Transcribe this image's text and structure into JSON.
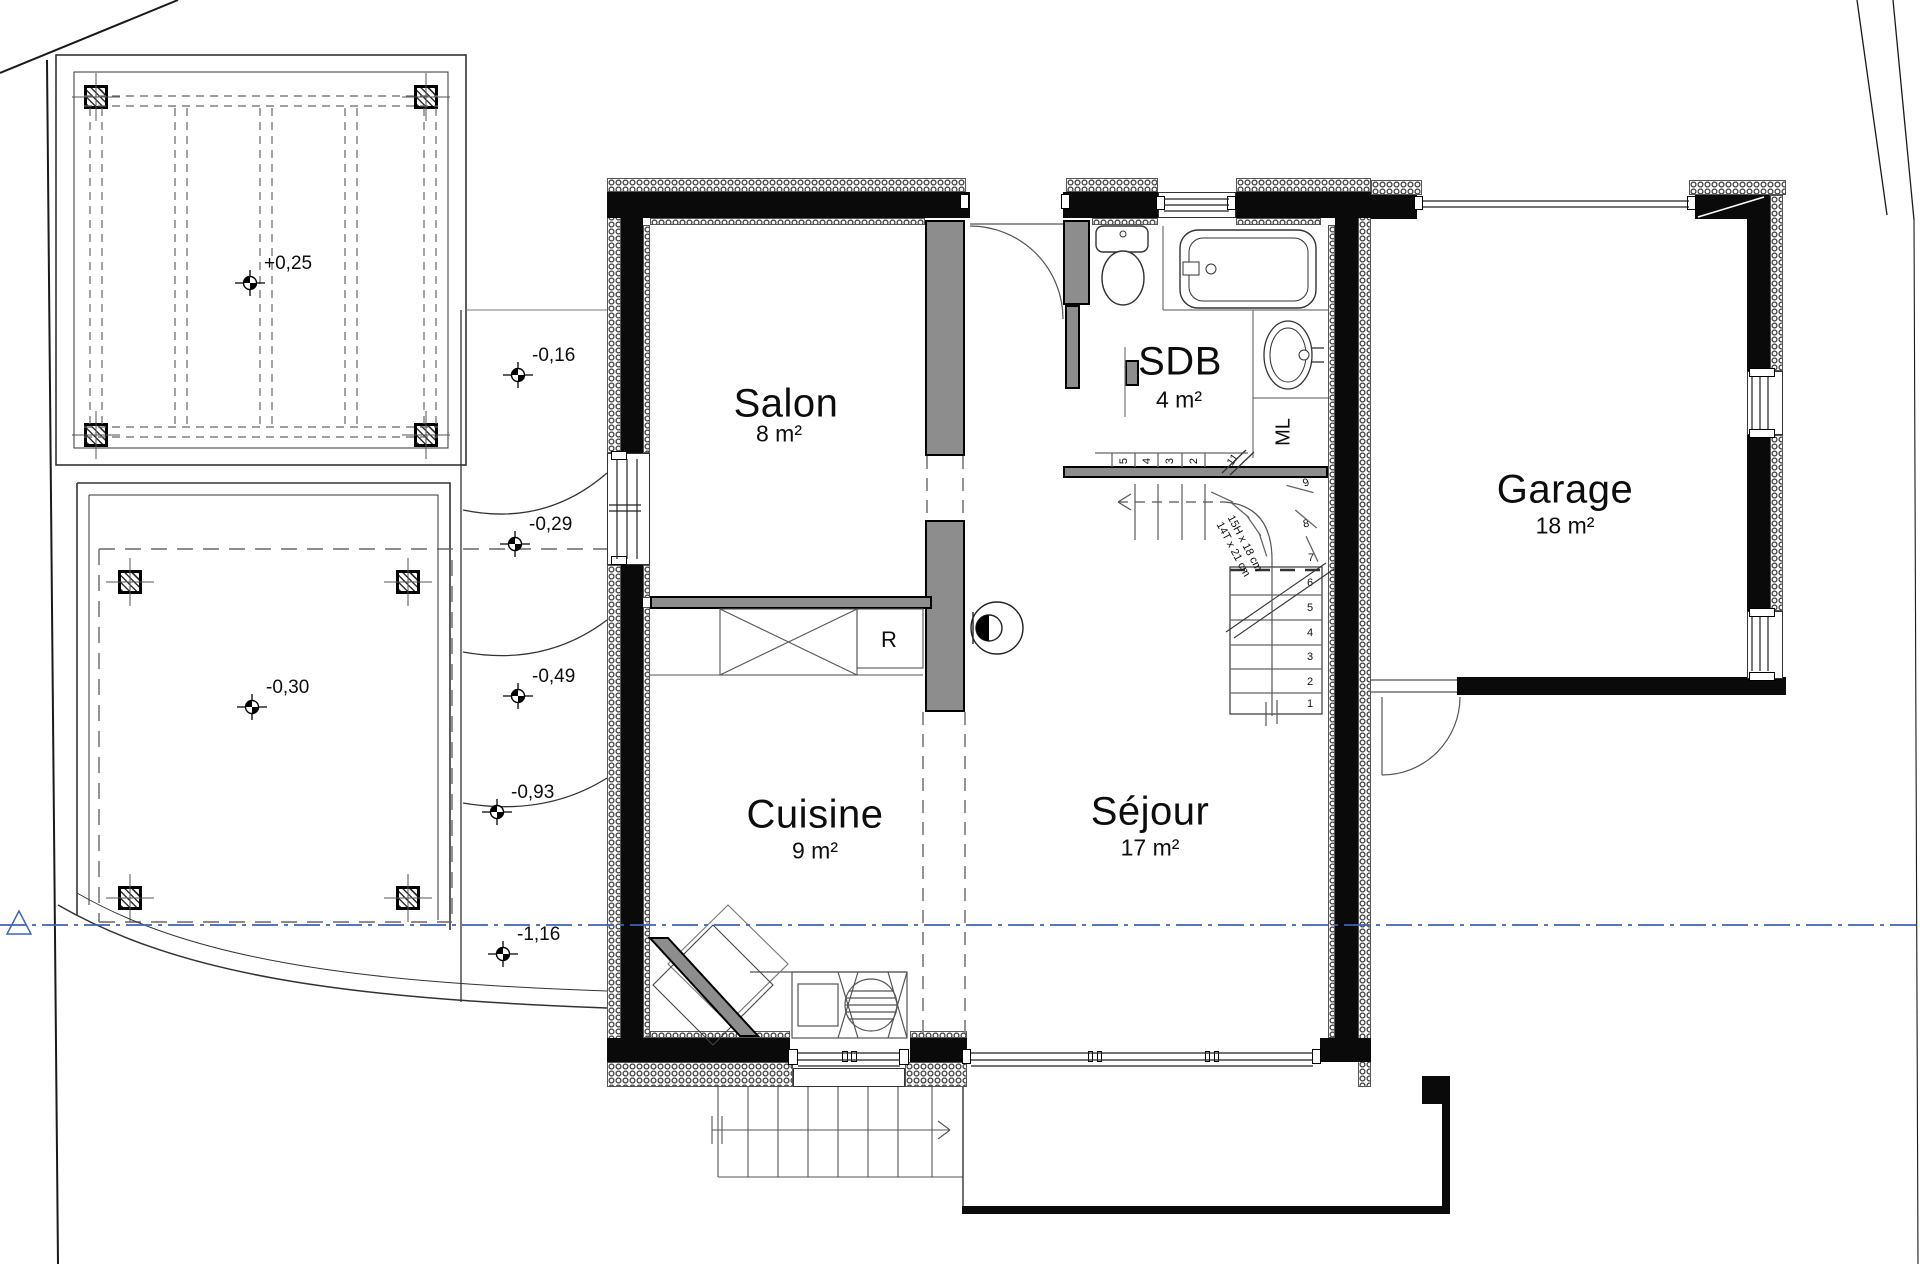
{
  "drawing": {
    "type": "floor-plan",
    "level": "rez-de-chaussée"
  },
  "colors": {
    "wall": "#0a0a0a",
    "partition": "#8d8d8d",
    "datum_line": "#3c64b8",
    "linework": "#333333"
  },
  "rooms": {
    "salon": {
      "name": "Salon",
      "area": "8 m²"
    },
    "cuisine": {
      "name": "Cuisine",
      "area": "9 m²"
    },
    "sejour": {
      "name": "Séjour",
      "area": "17 m²"
    },
    "sdb": {
      "name": "SDB",
      "area": "4 m²"
    },
    "garage": {
      "name": "Garage",
      "area": "18 m²"
    }
  },
  "appliances": {
    "fridge": "R",
    "washing_machine": "ML"
  },
  "elevations": {
    "deck": "+0,25",
    "terrace": "-0,30",
    "step1": "-0,16",
    "step2": "-0,29",
    "step3": "-0,49",
    "step4": "-0,93",
    "step5": "-1,16"
  },
  "stairs": {
    "riser_note": "15H x 18 cm",
    "tread_note": "14T x 21 cm",
    "lower_flight_numbers": [
      "6",
      "5",
      "4",
      "3",
      "2",
      "1"
    ],
    "winder_numbers": [
      "9",
      "8",
      "7"
    ],
    "upper_flight_numbers": [
      "5",
      "4",
      "3",
      "2",
      "11"
    ]
  }
}
